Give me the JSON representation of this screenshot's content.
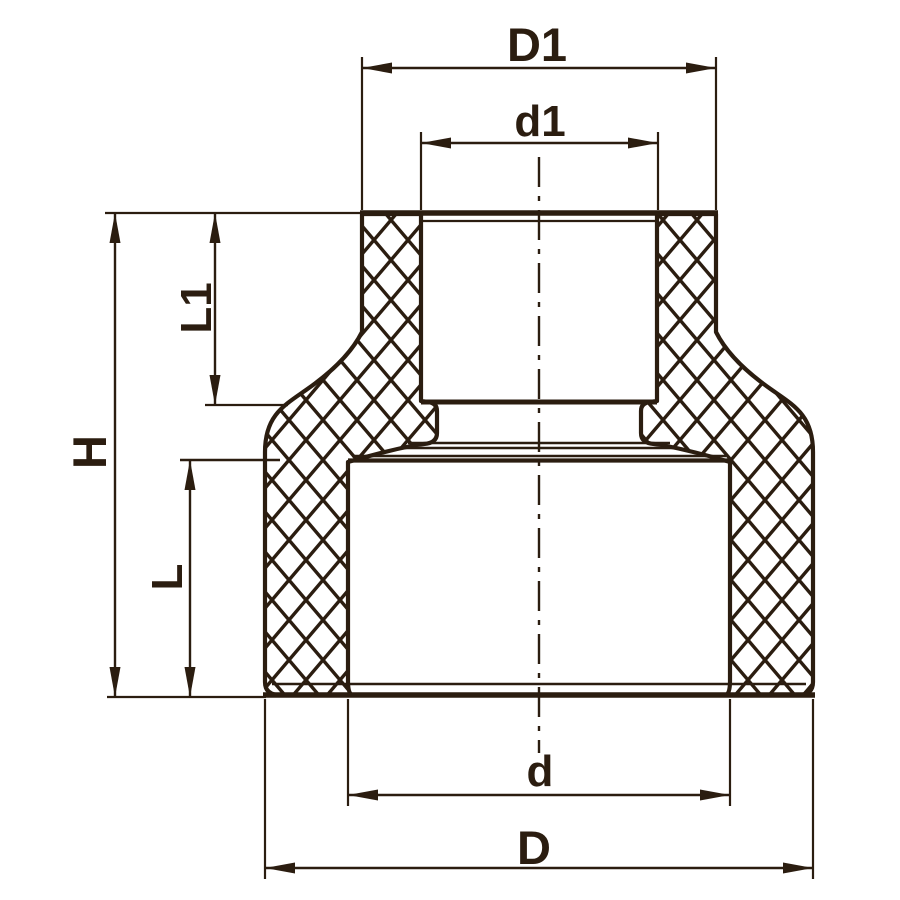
{
  "diagram": {
    "kind": "technical-drawing-cross-section-reducing-coupling",
    "colors": {
      "ink": "#2B1D10",
      "background": "#FFFFFF"
    },
    "dimension_labels": {
      "D1": "D1",
      "d1": "d1",
      "L1": "L1",
      "H": "H",
      "L": "L",
      "d": "d",
      "D": "D"
    }
  }
}
